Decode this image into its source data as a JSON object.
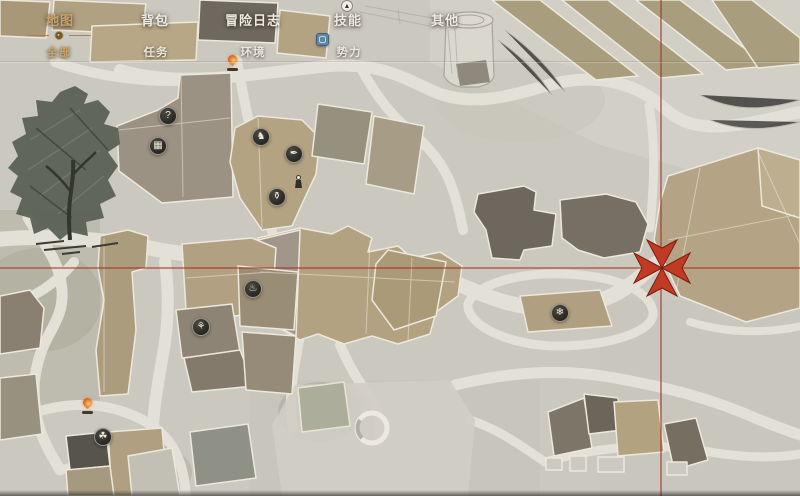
{
  "nav": {
    "tabs": [
      {
        "label": "地图",
        "active": true
      },
      {
        "label": "背包",
        "active": false
      },
      {
        "label": "冒险日志",
        "active": false
      },
      {
        "label": "技能",
        "active": false
      },
      {
        "label": "其他",
        "active": false
      }
    ],
    "active_tab": "地图",
    "subtabs": [
      {
        "label": "全部",
        "active": true
      },
      {
        "label": "任务",
        "active": false
      },
      {
        "label": "环境",
        "active": false
      },
      {
        "label": "势力",
        "active": false
      }
    ],
    "active_subtab": "全部"
  },
  "map": {
    "marker": {
      "name": "destination-marker",
      "x": 662,
      "y": 268,
      "color": "#c13a24"
    },
    "crosshair": {
      "x": 661,
      "y": 268,
      "color": "#a83326"
    },
    "poi_icons": [
      {
        "name": "question-poi-icon",
        "glyph": "?",
        "x": 168,
        "y": 116
      },
      {
        "name": "stall-poi-icon",
        "glyph": "▦",
        "x": 158,
        "y": 146
      },
      {
        "name": "animal-poi-icon",
        "glyph": "♞",
        "x": 261,
        "y": 137
      },
      {
        "name": "bird-poi-icon",
        "glyph": "✒",
        "x": 294,
        "y": 154
      },
      {
        "name": "jar-poi-icon",
        "glyph": "⚱",
        "x": 277,
        "y": 197
      },
      {
        "name": "teahouse-poi-icon",
        "glyph": "♨",
        "x": 253,
        "y": 289
      },
      {
        "name": "flower-poi-icon",
        "glyph": "⚘",
        "x": 201,
        "y": 327
      },
      {
        "name": "herb-poi-icon",
        "glyph": "☘",
        "x": 103,
        "y": 437
      },
      {
        "name": "bloom-poi-icon",
        "glyph": "❄",
        "x": 560,
        "y": 313
      }
    ],
    "campfires": [
      {
        "name": "campfire-icon",
        "x": 233,
        "y": 64
      },
      {
        "name": "campfire-icon",
        "x": 88,
        "y": 407
      }
    ],
    "npc_figure": {
      "name": "npc-figure-icon",
      "x": 299,
      "y": 181
    }
  },
  "colors": {
    "paper": "#cbc8bf",
    "road": "#e3e0d7",
    "building_tan": "#b3a383",
    "building_dark": "#6e675d",
    "active_tab_gold": "#c9a46a",
    "marker_red": "#c13a24"
  }
}
